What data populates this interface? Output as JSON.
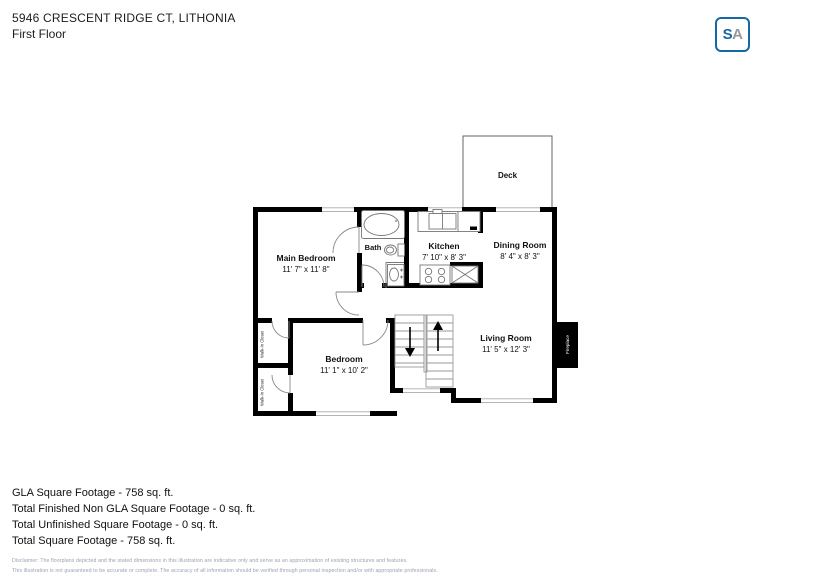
{
  "header": {
    "address": "5946 CRESCENT RIDGE CT, LITHONIA",
    "floor": "First Floor"
  },
  "logo": {
    "letter_s": "S",
    "letter_a": "A"
  },
  "colors": {
    "brand_blue": "#1568a2",
    "logo_gray": "#97989a",
    "wall_black": "#000000"
  },
  "rooms": {
    "deck": {
      "name": "Deck"
    },
    "main_bedroom": {
      "name": "Main Bedroom",
      "dims": "11' 7\" x 11' 8\""
    },
    "bath": {
      "name": "Bath"
    },
    "kitchen": {
      "name": "Kitchen",
      "dims": "7' 10\" x 8' 3\""
    },
    "dining_room": {
      "name": "Dining Room",
      "dims": "8' 4\" x 8' 3\""
    },
    "living_room": {
      "name": "Living Room",
      "dims": "11' 5\" x 12' 3\""
    },
    "bedroom": {
      "name": "Bedroom",
      "dims": "11' 1\" x 10' 2\""
    },
    "closet1": {
      "name": "Walk-In Closet"
    },
    "closet2": {
      "name": "Walk-In Closet"
    },
    "fireplace": {
      "name": "Fireplace"
    }
  },
  "summary": {
    "lines": [
      "GLA Square Footage - 758 sq. ft.",
      "Total Finished Non GLA Square Footage - 0 sq. ft.",
      "Total Unfinished Square Footage - 0 sq. ft.",
      "Total Square Footage - 758 sq. ft."
    ]
  },
  "disclaimer": {
    "line1": "Disclaimer: The floorplans depicted and the stated dimensions in this illustration are indicative only and serve as an approximation of existing structures and features.",
    "line2": "This illustration is not guaranteed to be accurate or complete. The accuracy of all information should be verified through personal inspection and/or with appropriate professionals."
  }
}
